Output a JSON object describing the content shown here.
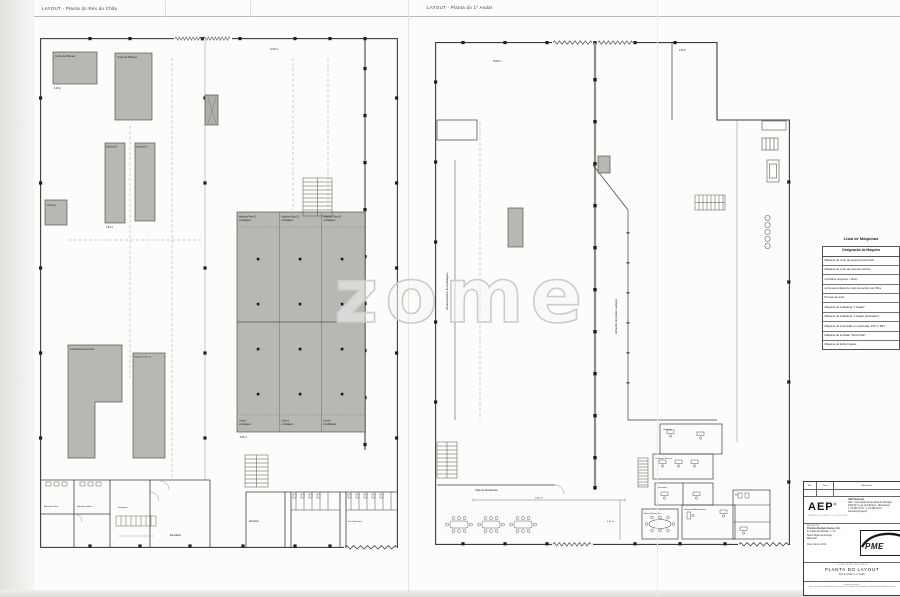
{
  "page": {
    "left_plan_title": "LAYOUT  -  Planta do Rés do Chão",
    "right_plan_title": "LAYOUT  -  Planta do 1º Andar",
    "watermark": "zome"
  },
  "left_plan": {
    "corte_placas": "Corte de Placas",
    "corte_blocos": "Corte de Blocos",
    "carrossel1": "Carrossel 1",
    "carrossel2": "Carrossel 2",
    "prensa": "Prensa",
    "flow1a": "Máquina Flow 01",
    "flow1b": "embalagem",
    "flow2a": "Máquina Flow 02",
    "flow2b": "embalagem",
    "flow3a": "Máquina Flow 03",
    "flow3b": "embalagem",
    "linha1a": "Linha 1",
    "linha1b": "embalagem",
    "linha2a": "Linha 2",
    "linha2b": "embalagem",
    "linha3a": "Linha 3",
    "linha3b": "Flexibilidade",
    "linha_manual": "Linha Manual de Corte",
    "maquina_flow_xl": "Máquina Flow XL",
    "balneario_f": "Balneário Fem.",
    "balneario_m": "Balneário Masc.",
    "vestiarios": "Vestiários",
    "refeitorio": "Refeitório",
    "sanitarias": "Inst. Sanitárias",
    "expedicao": "Expedição",
    "dims": [
      "4,00 m",
      "2,80 m",
      "6,35 m",
      "12,50 m"
    ]
  },
  "right_plan": {
    "armaz_embalagens": "Armazenamento de embalagens",
    "armaz_produto": "Armazém de produto acabado",
    "sala_refeicoes": "Sala de Refeições",
    "gabinete1": "Gabinete",
    "gabinete2": "Gabinete Técnico",
    "sala_reunioes": "Sala de Reuniões",
    "gabinete3": "Gabinete Administrativo",
    "secretaria": "Secretaria",
    "wc": "WC",
    "dims": [
      "1,80 m",
      "14,00 m",
      "4,50 m",
      "38,50 m"
    ]
  },
  "machine_list": {
    "title": "Lista de Máquinas",
    "header": "Designação de Máquina",
    "rows": [
      "Máquina de corte de espuma horizontal",
      "Máquina de corte de espuma vertical",
      "Colchões (espuma + fibra)",
      "Linha automática de corte de tecido com fibra",
      "Prensa de corte",
      "Máquina de soldadura \"L Sealer\"",
      "Máquina de soldadura \"L Sealer automático\"",
      "Máquina de impressão em películas, PVC e PET",
      "Máquina de embalar \"Flow Pack\"",
      "Máquina de fechar caixas"
    ]
  },
  "title_block": {
    "rev_label": "Rev.",
    "data_label": "Data",
    "desc_label": "Alterações",
    "aep_logo": "AEP",
    "aep_reg": "®",
    "aep_tagline": "CÂMARA DE COMÉRCIO E INDÚSTRIA",
    "aep_line1": "AEP Empresas",
    "aep_line2": "AEP - Associação Empresarial de Portugal",
    "aep_line3": "4450-617 Leça da Palmeira - Matosinhos",
    "aep_line4": "T. 22 998 15 00 - F. 22 998 15 19",
    "aep_line5": "www.aeportugal.pt",
    "requerente_label": "Requerente:",
    "requerente_name": "Positivo Absoluto Gomes, S.A.",
    "requerente_addr1": "R. Casal das Mouras, n.º 57",
    "requerente_addr2": "Santo Miguel de Arcanjo",
    "requerente_addr3": "Mancelos",
    "data_field": "Data: Janeiro 2021",
    "pme_logo": "PME",
    "localizacao": "LOCALIZAÇÃO EM PLANTA",
    "doc_title": "PLANTA DO LAYOUT",
    "doc_subtitle": "Rés do Chão e 1.º Andar",
    "fine1": "Este desenho é propriedade da AEP. Qualquer reprodução ou divulgação, no todo ou em parte, carece de autorização escrita.",
    "fine2": "Cotas em metros, salvo indicação em contrário. O desenho não dispensa a verificação das medidas em obra."
  }
}
